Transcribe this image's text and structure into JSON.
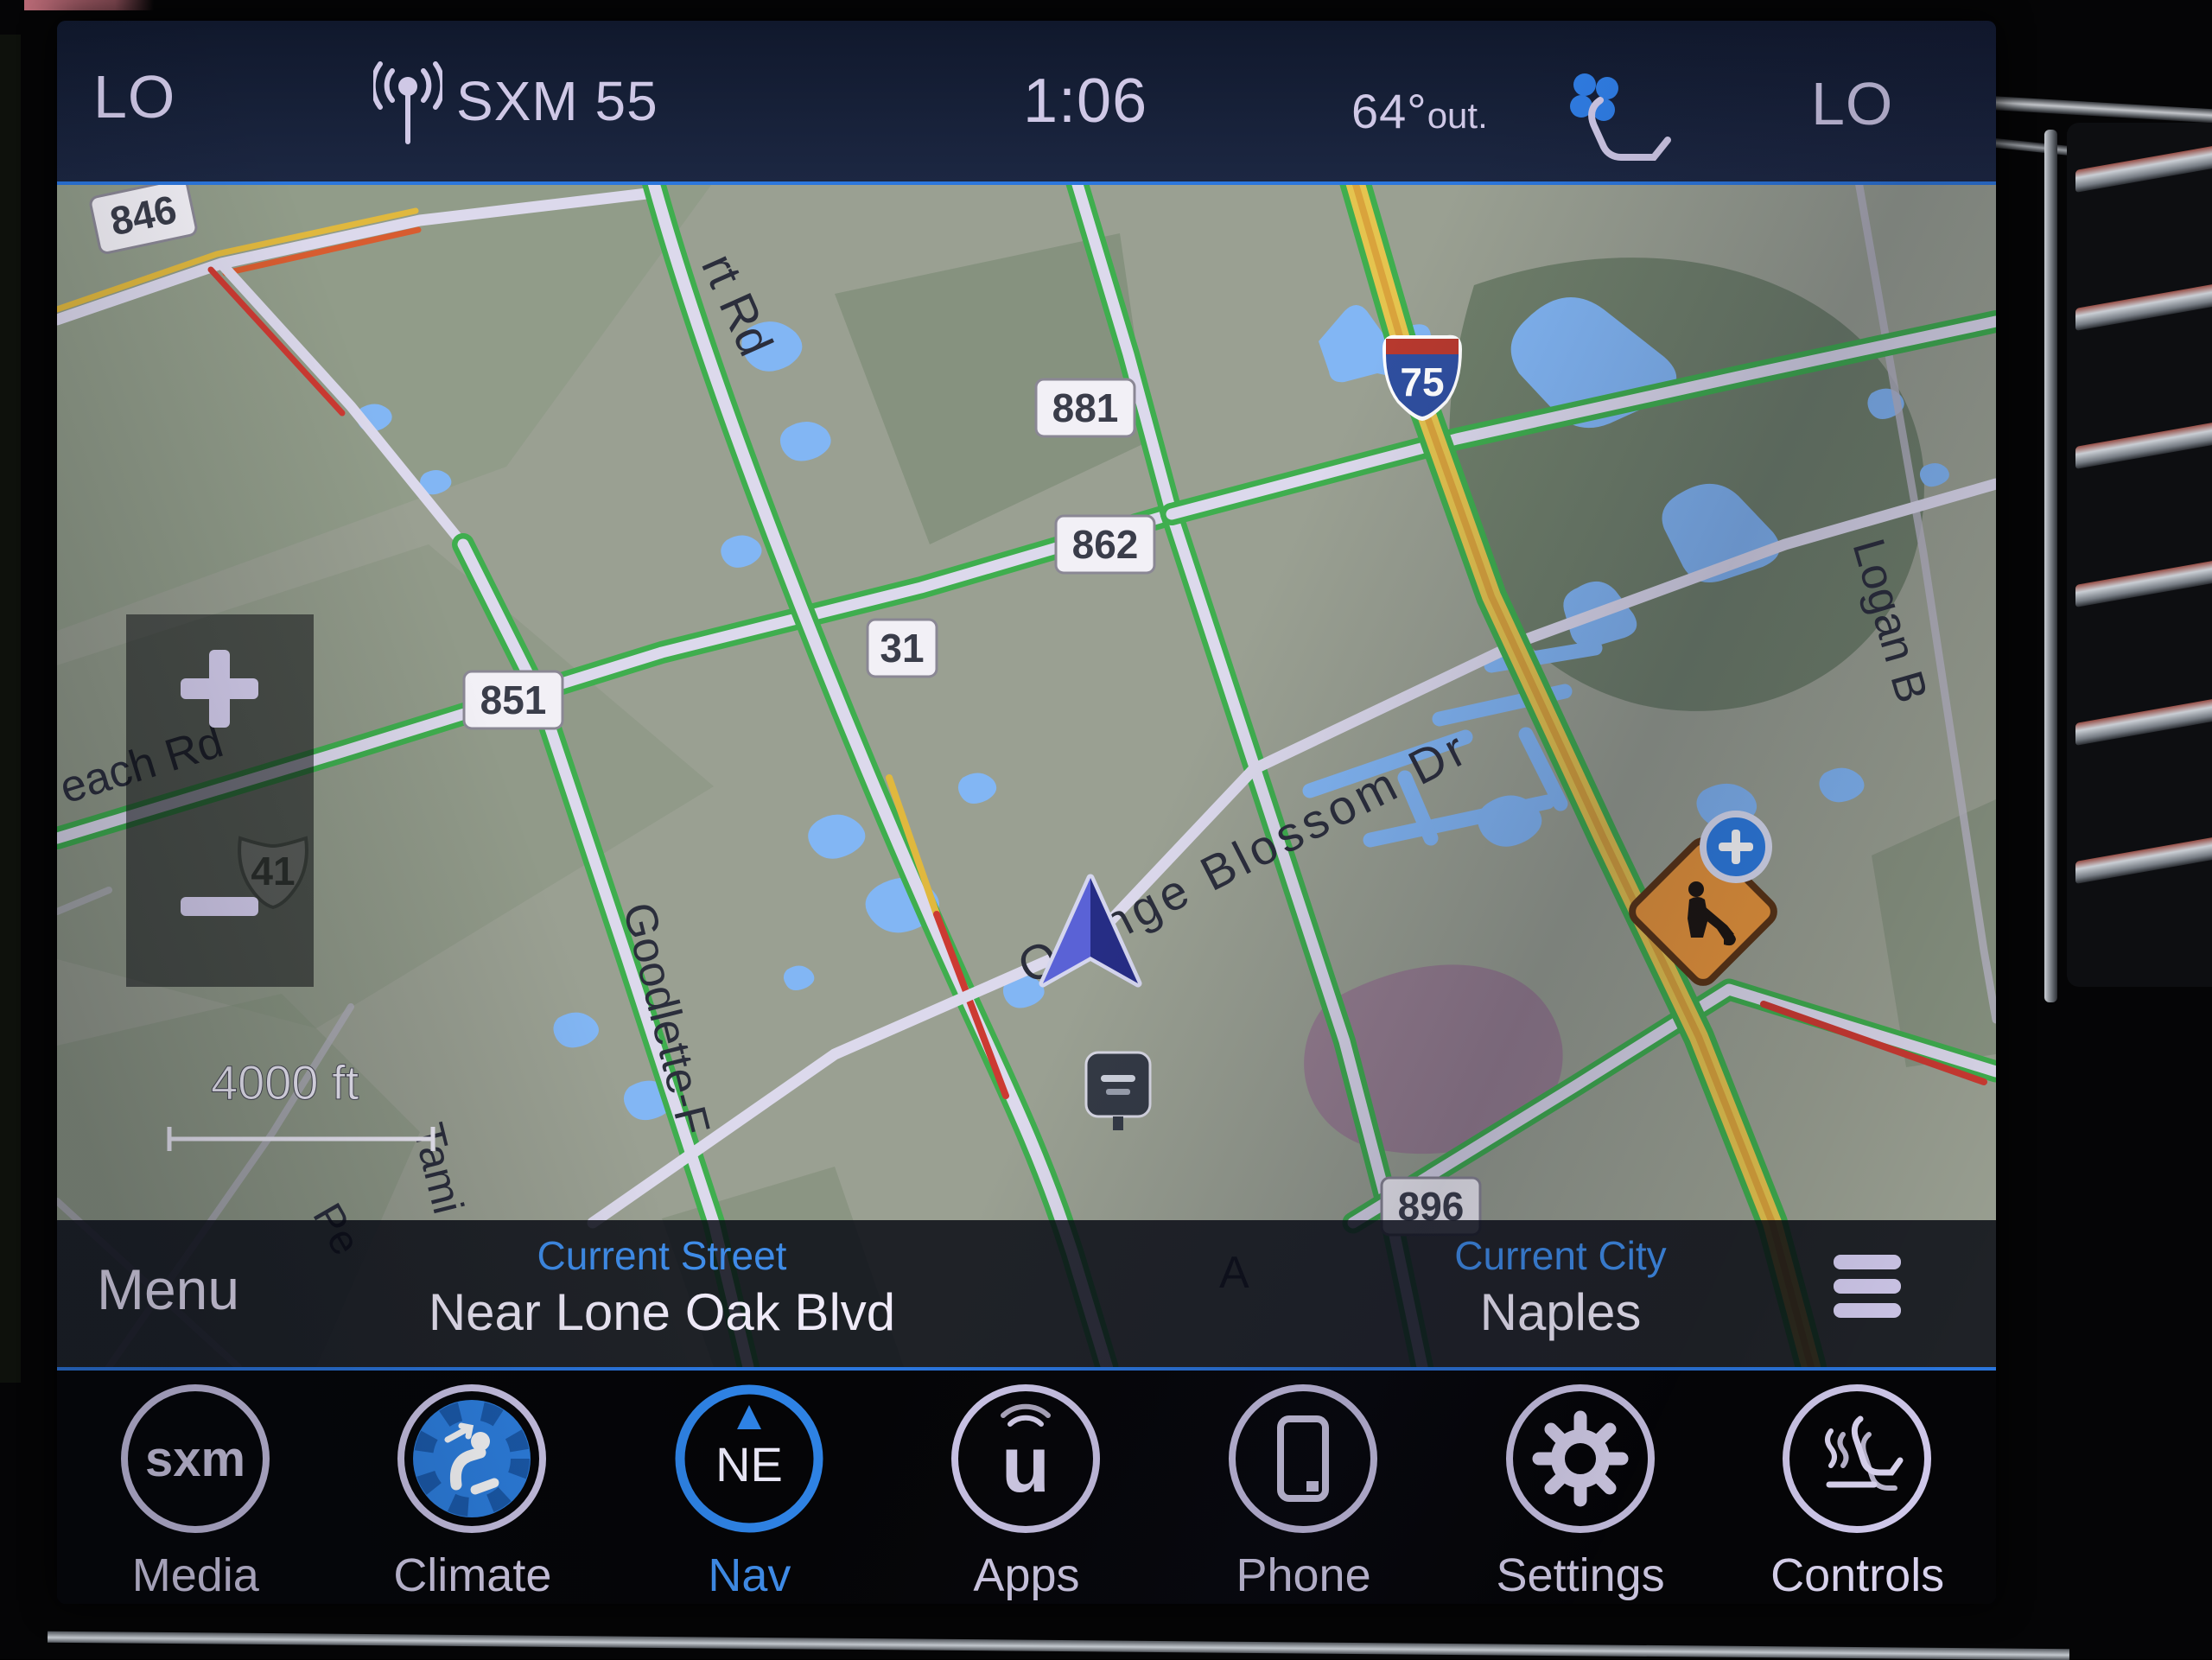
{
  "status_bar": {
    "left_temp_setting": "LO",
    "station": "SXM 55",
    "time": "1:06",
    "outside_temp": "64°",
    "outside_temp_suffix": "out.",
    "right_temp_setting": "LO"
  },
  "map": {
    "scale_label": "4000 ft",
    "zoom_in": "+",
    "zoom_out": "−",
    "shields": {
      "s846": "846",
      "s881": "881",
      "s862": "862",
      "s31": "31",
      "s851": "851",
      "s896": "896",
      "s41": "41",
      "i75": "75"
    },
    "road_labels": {
      "airport": "rt Rd",
      "orange_blossom": "Orange Blossom Dr",
      "beach": "each Rd",
      "goodlette": "Goodlette-F",
      "logan": "Logan B",
      "tamiami": "Tami",
      "pelican": "Pe",
      "fragment_a": "A"
    }
  },
  "info_bar": {
    "menu": "Menu",
    "street_label": "Current Street",
    "street_value": "Near Lone Oak Blvd",
    "city_label": "Current City",
    "city_value": "Naples"
  },
  "app_bar": {
    "items": [
      {
        "label": "Media",
        "badge": "sxm"
      },
      {
        "label": "Climate"
      },
      {
        "label": "Nav",
        "compass": "NE",
        "active": true
      },
      {
        "label": "Apps",
        "glyph": "u"
      },
      {
        "label": "Phone"
      },
      {
        "label": "Settings"
      },
      {
        "label": "Controls"
      }
    ]
  },
  "colors": {
    "accent_blue": "#2b76dd",
    "nav_active": "#3f8ce8",
    "icon_lavender": "#d6cfee",
    "water": "#82b6f4",
    "traffic_green": "#3fae4e",
    "traffic_red": "#c23b33",
    "traffic_yellow": "#e0b83e",
    "interstate_yellow": "#e5c44f"
  }
}
